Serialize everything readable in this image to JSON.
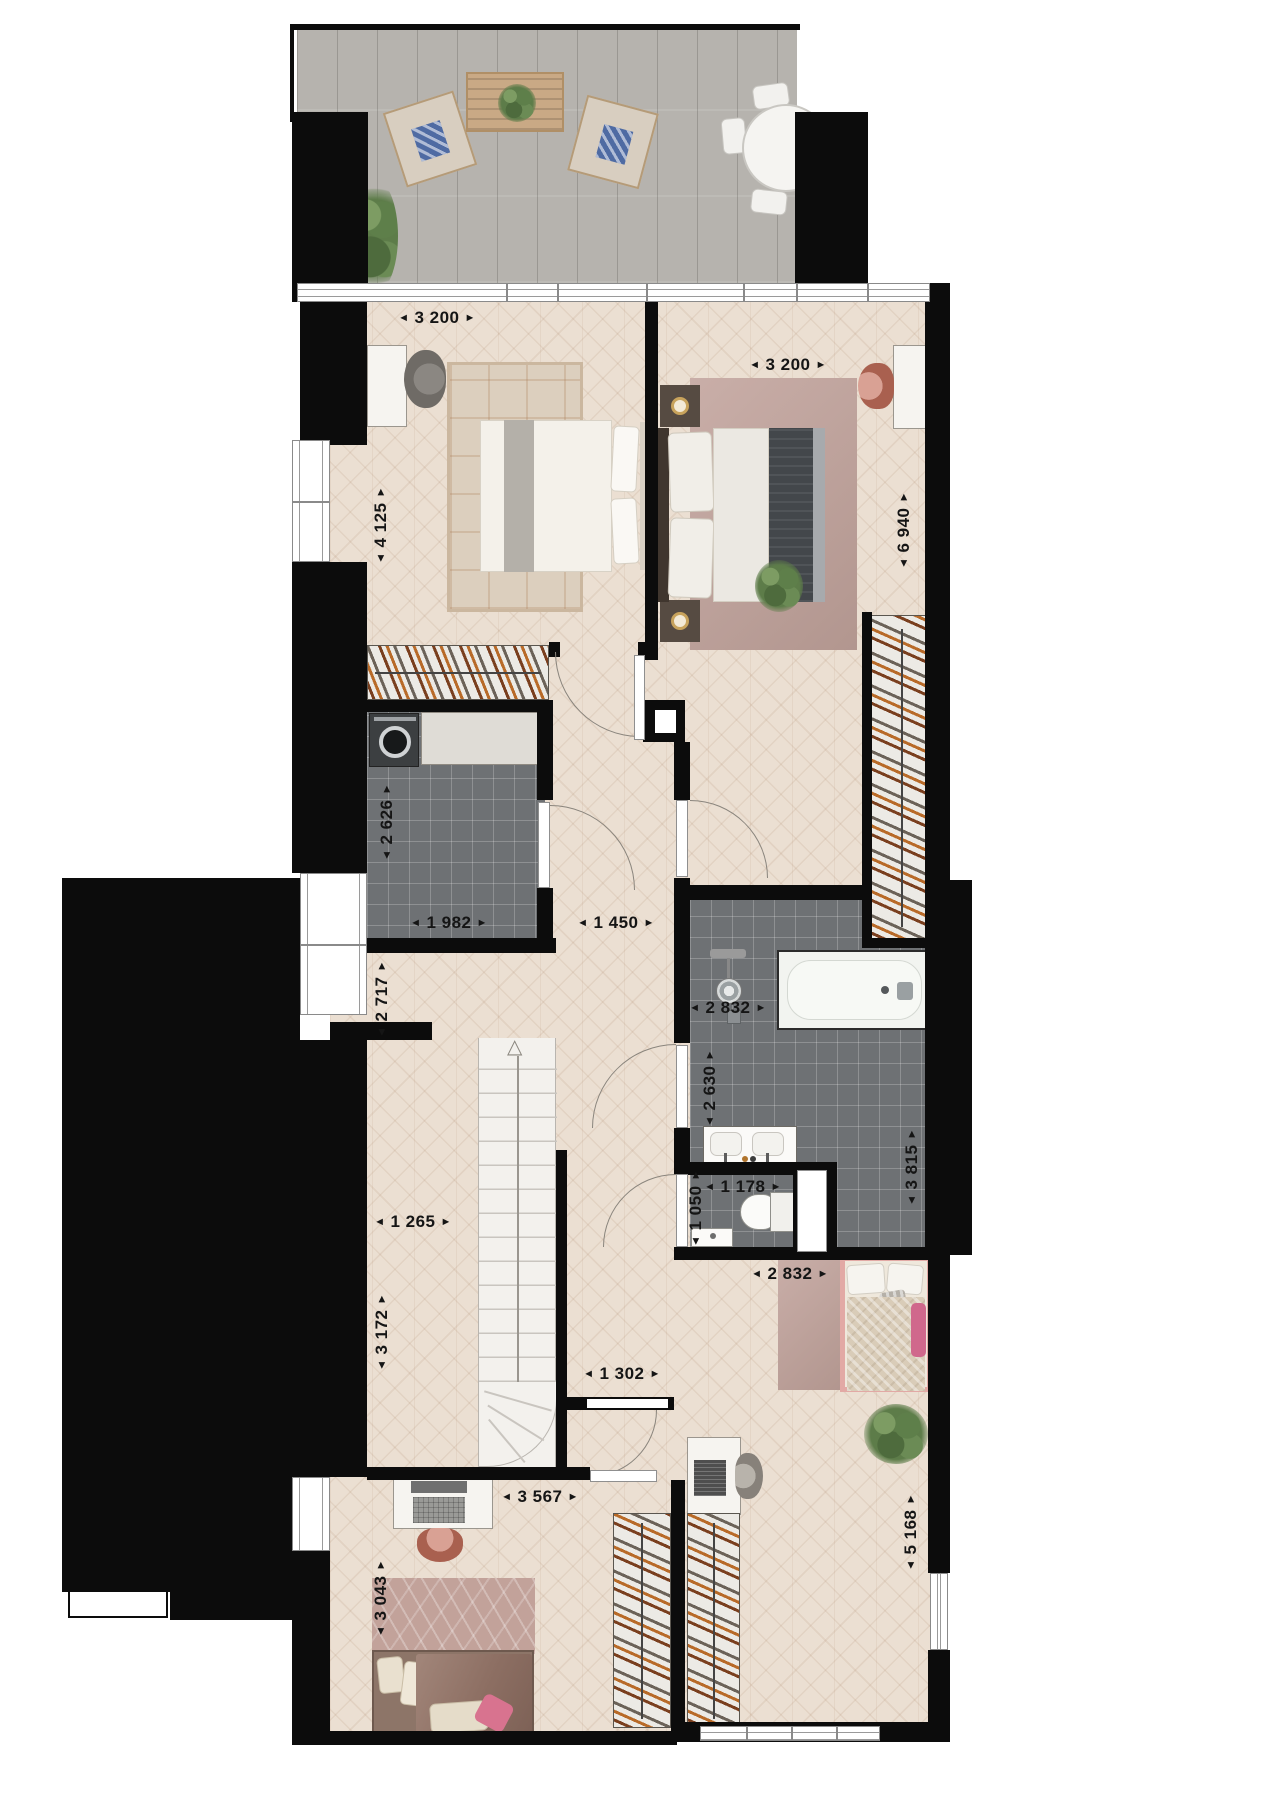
{
  "glyphs": {
    "arrow_left": "◄",
    "arrow_right": "►",
    "stair_direction_arrow": "△"
  },
  "dimensions": [
    {
      "name": "bedroom-top-left-width",
      "value": "3 200",
      "orientation": "horizontal"
    },
    {
      "name": "bedroom-top-right-width",
      "value": "3 200",
      "orientation": "horizontal"
    },
    {
      "name": "bedroom-top-left-depth",
      "value": "4 125",
      "orientation": "vertical"
    },
    {
      "name": "bedroom-top-right-depth",
      "value": "6 940",
      "orientation": "vertical"
    },
    {
      "name": "laundry-depth",
      "value": "2 626",
      "orientation": "vertical"
    },
    {
      "name": "laundry-width",
      "value": "1 982",
      "orientation": "horizontal"
    },
    {
      "name": "hall-corridor-width",
      "value": "1 450",
      "orientation": "horizontal"
    },
    {
      "name": "hall-depth",
      "value": "2 717",
      "orientation": "vertical"
    },
    {
      "name": "bathroom-width",
      "value": "2 832",
      "orientation": "horizontal"
    },
    {
      "name": "bathroom-depth",
      "value": "2 630",
      "orientation": "vertical"
    },
    {
      "name": "bathroom-right-depth",
      "value": "3 815",
      "orientation": "vertical"
    },
    {
      "name": "wc-width",
      "value": "1 178",
      "orientation": "horizontal"
    },
    {
      "name": "wc-depth",
      "value": "1 050",
      "orientation": "vertical"
    },
    {
      "name": "stair-landing-width",
      "value": "1 265",
      "orientation": "horizontal"
    },
    {
      "name": "stair-landing-depth",
      "value": "3 172",
      "orientation": "vertical"
    },
    {
      "name": "lower-hall-width",
      "value": "1 302",
      "orientation": "horizontal"
    },
    {
      "name": "bedroom-bottom-left-width",
      "value": "3 567",
      "orientation": "horizontal"
    },
    {
      "name": "bedroom-bottom-left-depth",
      "value": "3 043",
      "orientation": "vertical"
    },
    {
      "name": "bedroom-bottom-right-width",
      "value": "2 832",
      "orientation": "horizontal"
    },
    {
      "name": "bedroom-bottom-right-depth",
      "value": "5 168",
      "orientation": "vertical"
    }
  ],
  "colors": {
    "wall": "#0c0c0c",
    "wood_floor": "#ebdfd2",
    "terrace_deck": "#b6b3ae",
    "wet_room_tile": "#6e7174",
    "accent_pink": "#e2a9a5",
    "accent_terracotta": "#bf7a6d",
    "plant_green": "#5d7c49"
  }
}
